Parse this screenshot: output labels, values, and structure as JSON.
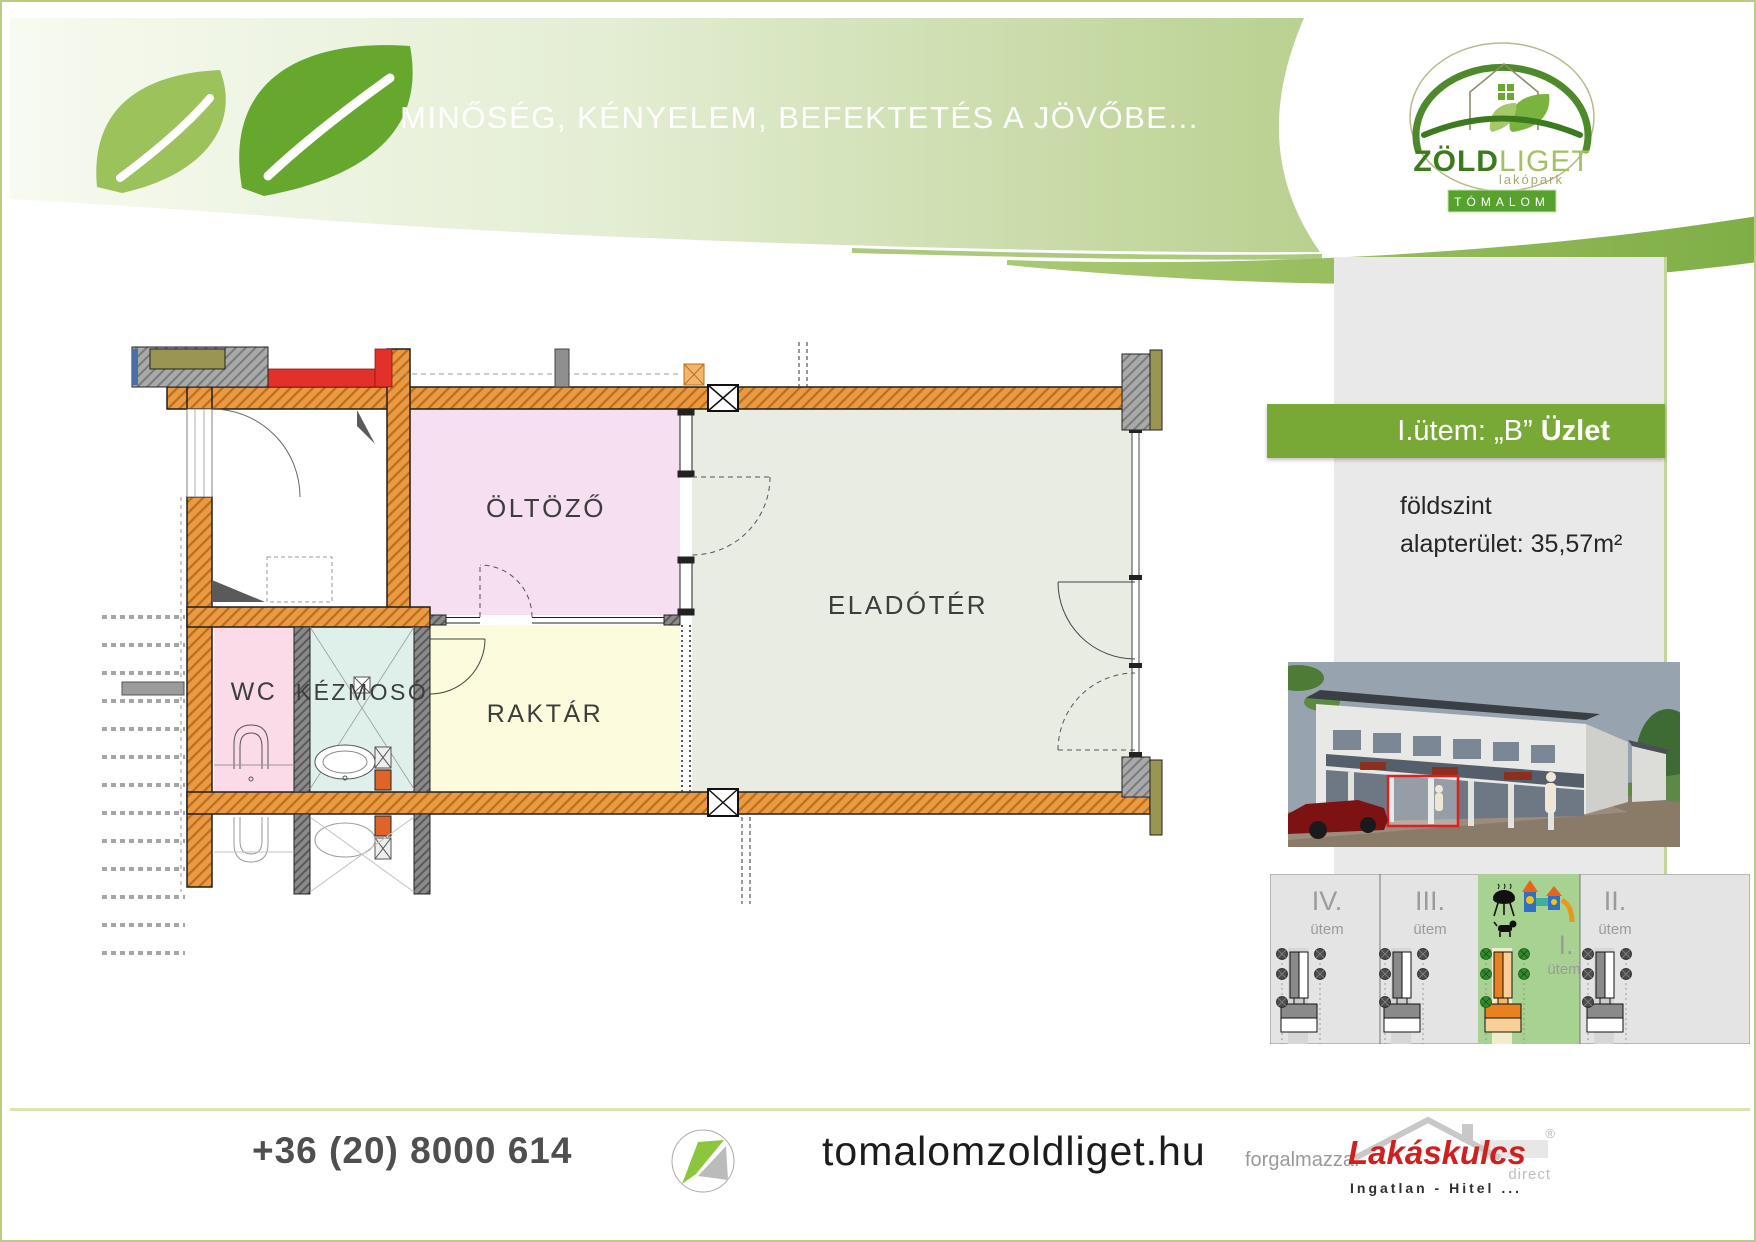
{
  "header": {
    "slogan": "MINŐSÉG, KÉNYELEM, BEFEKTETÉS A JÖVŐBE...",
    "logo": {
      "zold": "ZÖLD",
      "liget": "LIGET",
      "subtitle": "lakópark",
      "badge": "TÓMALOM"
    }
  },
  "sidebar": {
    "banner": {
      "prefix": "I.ütem: „B” ",
      "unit": "Üzlet",
      "bg": "#78a936"
    },
    "floor": "földszint",
    "area": "alapterület: 35,57m²"
  },
  "floor_plan": {
    "rooms": [
      {
        "name": "ÖLTÖZŐ",
        "color": "#f6dff0"
      },
      {
        "name": "ELADÓTÉR",
        "color": "#e9ece2"
      },
      {
        "name": "WC",
        "color": "#fadbe7"
      },
      {
        "name": "KÉZMOSÓ",
        "color": "#def0e9"
      },
      {
        "name": "RAKTÁR",
        "color": "#fcfbdd"
      }
    ],
    "wall_color": "#eb9a42"
  },
  "site_map": {
    "phases": [
      {
        "numeral": "IV.",
        "label": "ütem",
        "highlighted": false
      },
      {
        "numeral": "III.",
        "label": "ütem",
        "highlighted": false
      },
      {
        "numeral": "I.",
        "label": "ütem",
        "highlighted": true
      },
      {
        "numeral": "II.",
        "label": "ütem",
        "highlighted": false
      }
    ],
    "highlight_color": "#a8d291"
  },
  "footer": {
    "phone": "+36 (20) 8000 614",
    "website": "tomalomzoldliget.hu",
    "distributor_label": "forgalmazza:",
    "brand": {
      "name": "Lakáskulcs",
      "registered": "®",
      "direct": "direct",
      "tagline": "Ingatlan - Hitel ..."
    }
  }
}
